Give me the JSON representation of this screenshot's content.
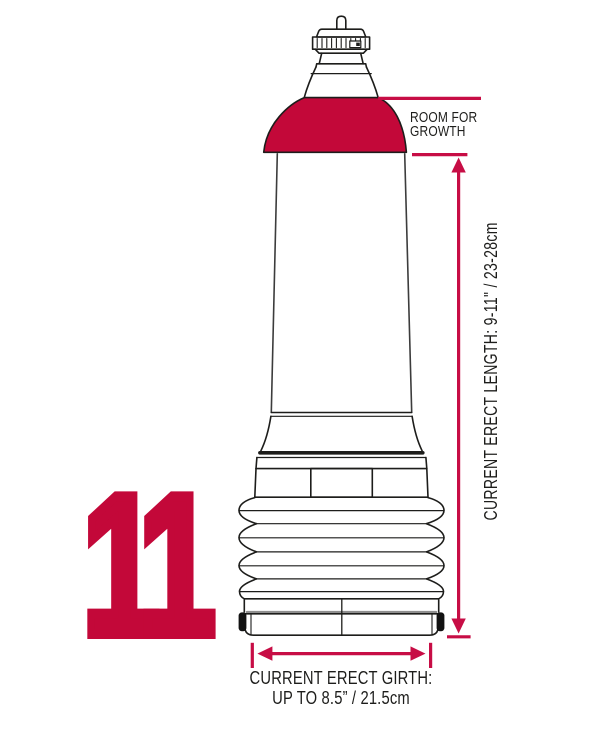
{
  "page": {
    "background": "#ffffff",
    "width": 603,
    "height": 732
  },
  "colors": {
    "accent-red": "#C30839",
    "measure-red": "#C70D45",
    "outline-dark": "#1D1D1B",
    "cap-black": "#121212",
    "text-dark": "#1D1D1B"
  },
  "figure": {
    "number": "11",
    "annotations": {
      "room_for_growth": {
        "line1": "ROOM FOR",
        "line2": "GROWTH"
      },
      "length": "CURRENT ERECT LENGTH: 9-11\" / 23-28cm",
      "girth": {
        "line1": "CURRENT ERECT GIRTH:",
        "line2": "UP TO 8.5” / 21.5cm"
      }
    }
  }
}
